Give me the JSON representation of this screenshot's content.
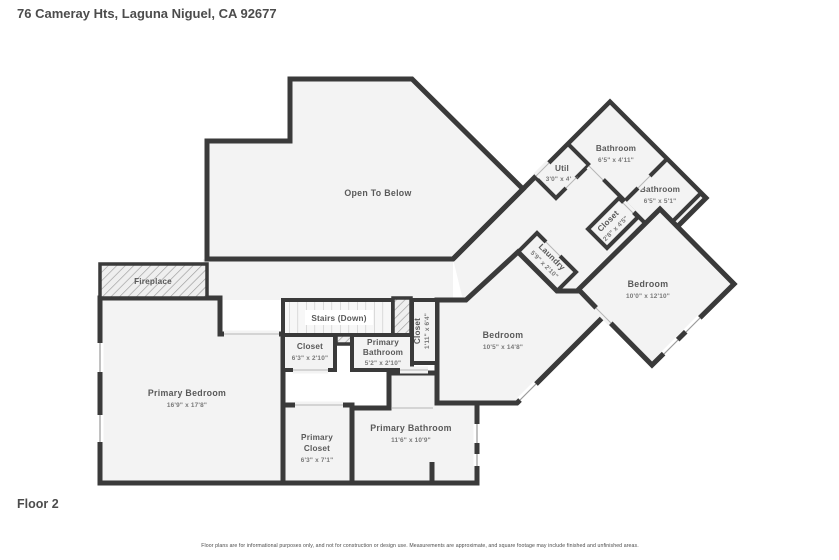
{
  "header": {
    "address": "76 Cameray Hts, Laguna Niguel, CA 92677"
  },
  "floor_label": "Floor 2",
  "disclaimer": "Floor plans are for informational purposes only, and not for construction or design use. Measurements are approximate, and square footage may include finished and unfinished areas.",
  "palette": {
    "wall": "#3a3a3a",
    "floor_fill": "#f3f3f3",
    "label": "#595959",
    "dims": "#787878"
  },
  "rooms": {
    "open_to_below": {
      "name": "Open To Below"
    },
    "bathroom_top": {
      "name": "Bathroom",
      "dims": "6'5\" x 4'11\""
    },
    "bathroom_right": {
      "name": "Bathroom",
      "dims": "6'5\" x 5'1\""
    },
    "util": {
      "name": "Util",
      "dims": "3'0\" x 4'8\""
    },
    "closet_diag": {
      "name": "Closet",
      "dims": "2'8\" x 4'5\""
    },
    "laundry": {
      "name": "Laundry",
      "dims": "5'9\" x 2'10\""
    },
    "bedroom_right": {
      "name": "Bedroom",
      "dims": "10'0\" x 12'10\""
    },
    "bedroom_center": {
      "name": "Bedroom",
      "dims": "10'5\" x 14'8\""
    },
    "stairs": {
      "name": "Stairs (Down)"
    },
    "closet_hall": {
      "name": "Closet",
      "dims": "6'3\" x 2'10\""
    },
    "primary_bathroom_small": {
      "name1": "Primary",
      "name2": "Bathroom",
      "dims": "5'2\" x 2'10\""
    },
    "closet_tall": {
      "name": "Closet",
      "dims": "1'11\" x 6'4\""
    },
    "primary_bedroom": {
      "name": "Primary Bedroom",
      "dims": "16'9\" x 17'8\""
    },
    "fireplace": {
      "name": "Fireplace"
    },
    "primary_closet": {
      "name1": "Primary",
      "name2": "Closet",
      "dims": "6'3\" x 7'1\""
    },
    "primary_bathroom": {
      "name": "Primary Bathroom",
      "dims": "11'6\" x 10'9\""
    }
  }
}
